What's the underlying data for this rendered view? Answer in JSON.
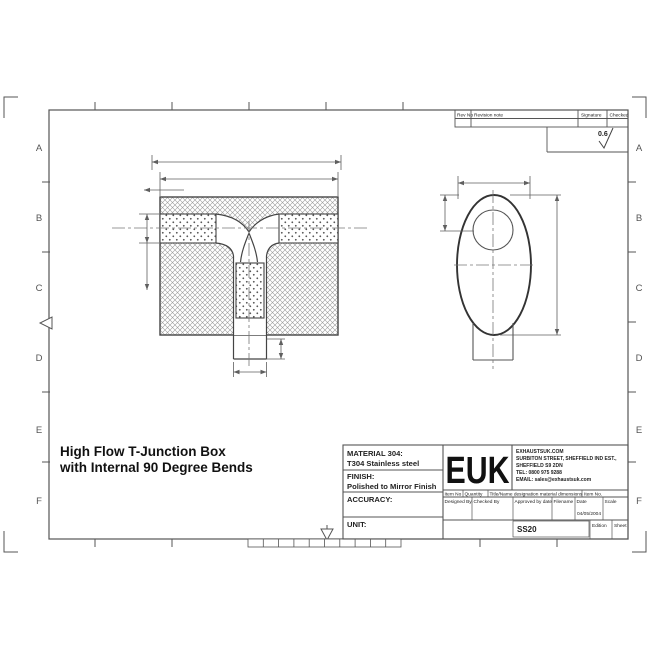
{
  "colors": {
    "line": "#444444",
    "dim": "#5f5f5f",
    "centerline": "#777777",
    "hatch": "#9b9b9b",
    "background": "#ffffff"
  },
  "title": {
    "line1": "High Flow T-Junction Box",
    "line2": "with Internal 90 Degree Bends"
  },
  "zones": {
    "letters": [
      "A",
      "B",
      "C",
      "D",
      "E",
      "F"
    ]
  },
  "revision": {
    "rev_no": "Rev No",
    "note": "Revision note",
    "signature": "Signature",
    "checked": "Checked",
    "surface_finish": "0.6"
  },
  "block": {
    "material_label": "MATERIAL 304:",
    "material_value": "T304 Stainless steel",
    "finish_label": "FINISH:",
    "finish_value": "Polished to Mirror Finish",
    "accuracy_label": "ACCURACY:",
    "unit_label": "UNIT:",
    "logo": "EUK",
    "company": {
      "line1": "EXHAUSTSUK.COM",
      "line2": "SURBITON STREET, SHEFFIELD IND EST.,",
      "line3": "SHEFFIELD S9 2DN",
      "line4": "TEL: 0800 975 9288",
      "line5": "EMAIL: sales@exhaustsuk.com"
    },
    "header": {
      "item_no": "Item No",
      "quantity": "Quantity",
      "title_name": "Title/Name designation material dimensions",
      "item_no2": "Item No."
    },
    "fields": {
      "designed_by": "Designed By.",
      "checked_by": "Checked By",
      "approved": "Approved by date",
      "filename": "Filename",
      "date": "Date",
      "scale": "Scale"
    },
    "date_value": "04/05/2004",
    "drawing_number": "SS20",
    "edition_label": "Edition",
    "sheet_label": "Sheet"
  }
}
